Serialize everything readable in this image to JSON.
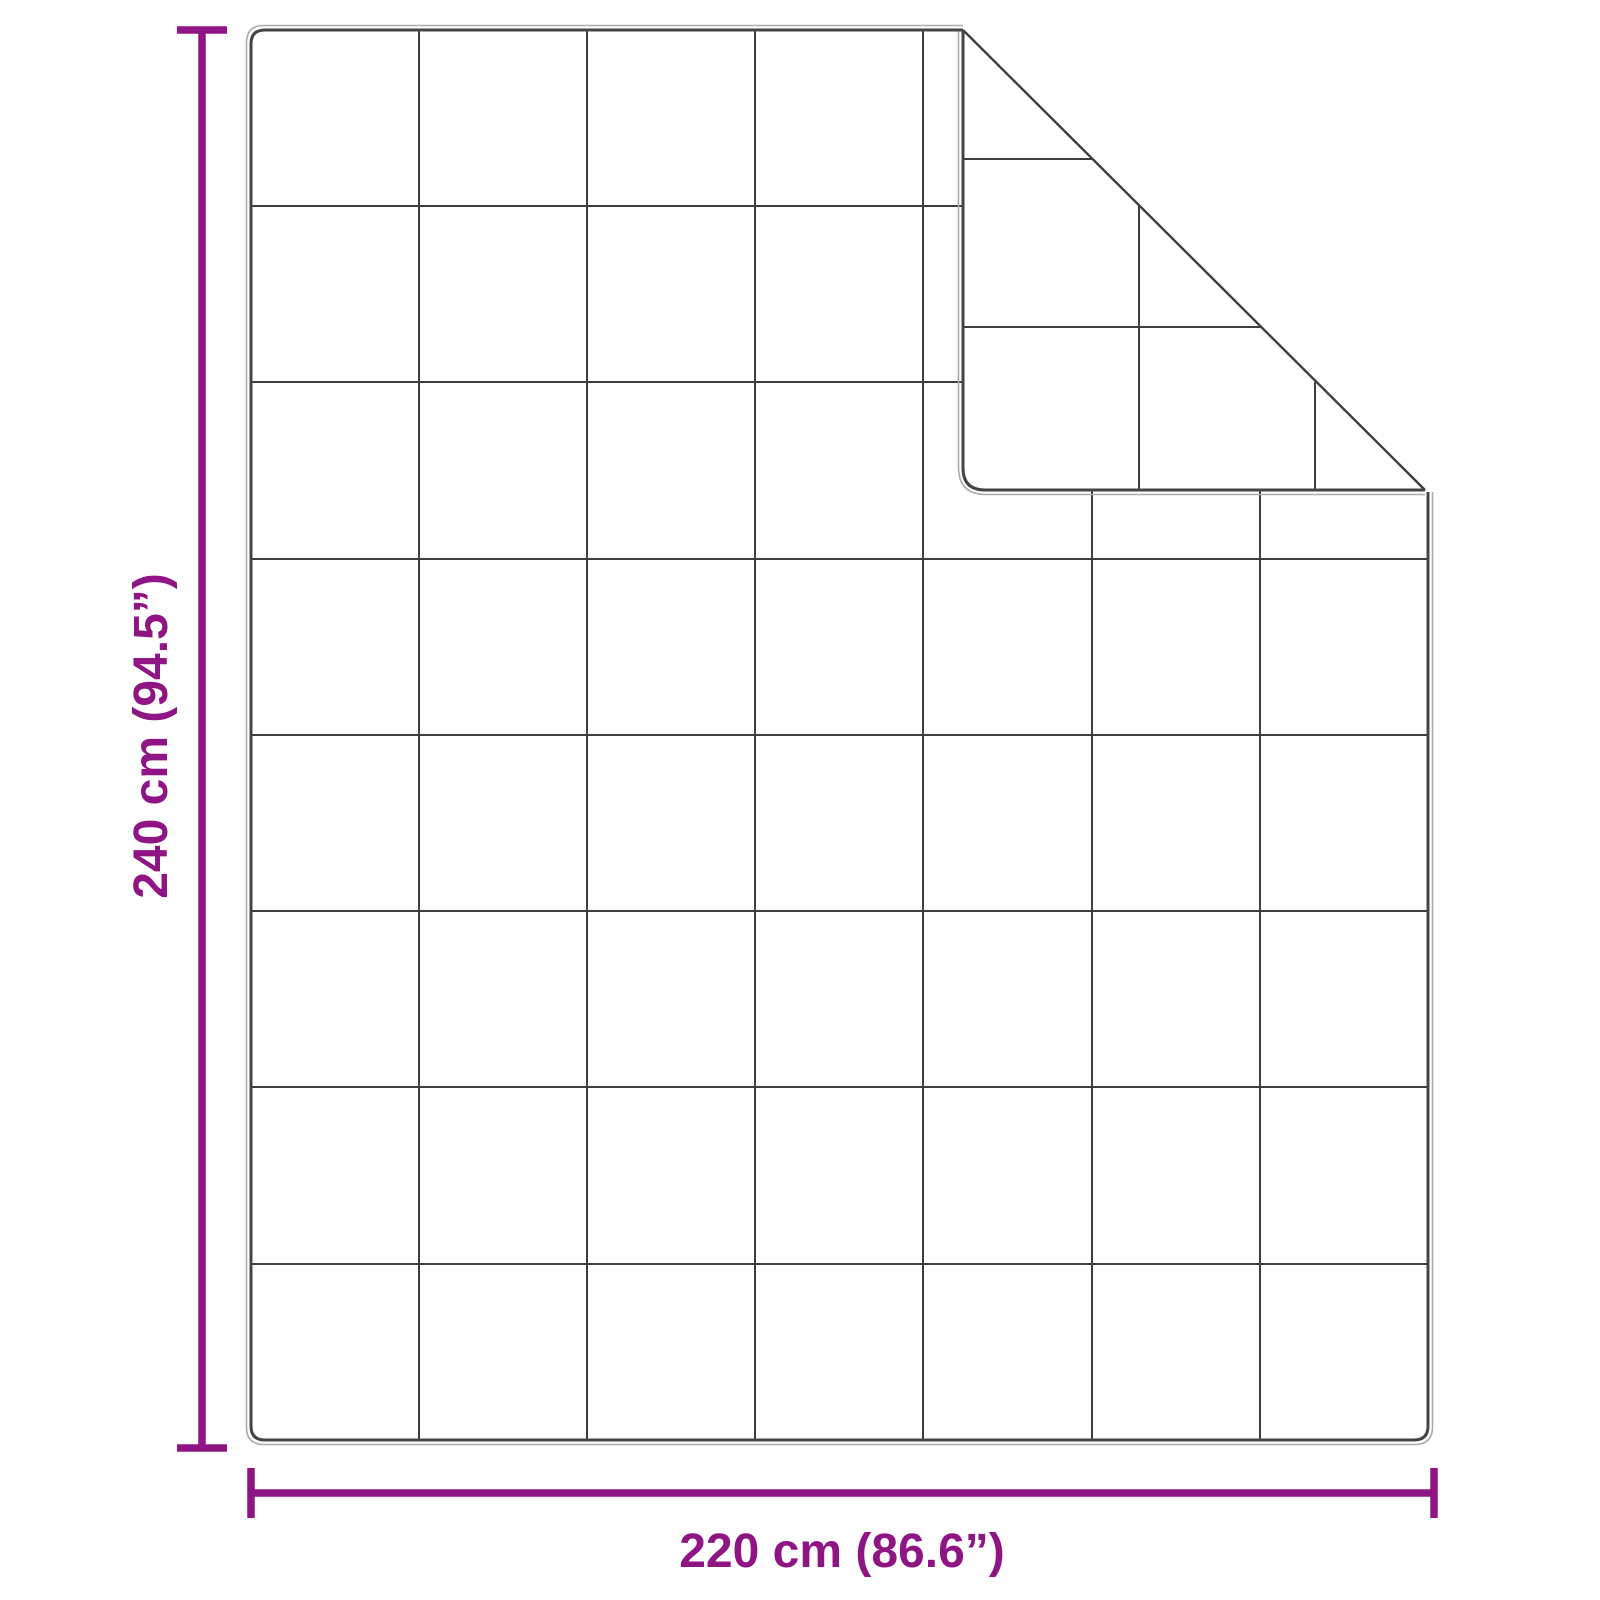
{
  "dimensions": {
    "height": {
      "label": "240 cm (94.5”)"
    },
    "width": {
      "label": "220 cm (86.6”)"
    }
  },
  "blanket": {
    "grid_columns": 7,
    "grid_rows": 8,
    "fold": "top-right corner folded over showing quilted back side"
  },
  "colors": {
    "dimension": "#8E1583",
    "outline_dark": "#454545",
    "outline_light": "#ABABAB",
    "grid_line": "#3E3E3E",
    "background": "#FFFFFF"
  }
}
